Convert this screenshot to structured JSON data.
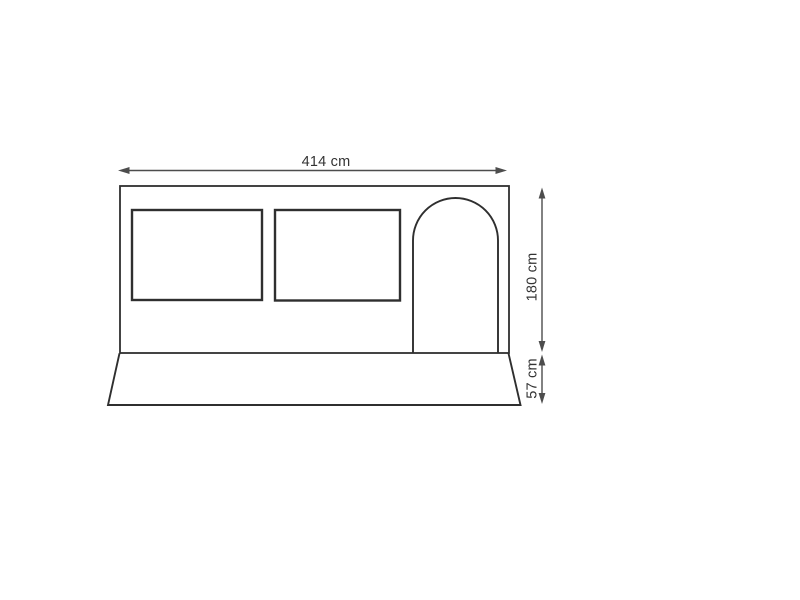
{
  "drawing": {
    "dimensions": {
      "width_label": "414 cm",
      "height_label": "180 cm",
      "skirt_label": "57 cm"
    },
    "parts": {
      "panel": "side-panel",
      "window_left": "window-left",
      "window_right": "window-right",
      "door": "arched-door",
      "skirt": "ground-skirt"
    },
    "colors": {
      "background": "#ffffff",
      "shape_outline": "#2f2f2f",
      "dimension_lines": "#4d4d4d",
      "label_text": "#333333"
    }
  }
}
